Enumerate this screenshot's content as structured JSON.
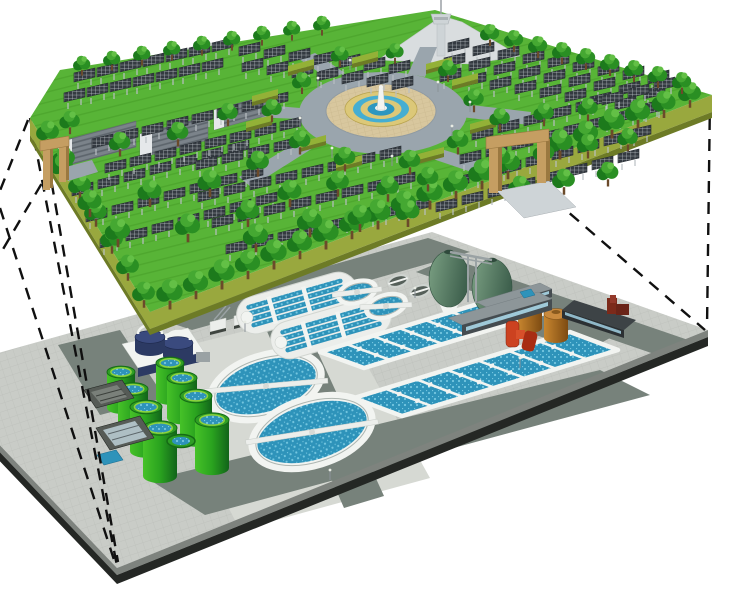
{
  "title": "Cutaway 3D illustration: underground wastewater treatment plant beneath a rooftop solar park with fountain plaza",
  "colors": {
    "grass": "#58b437",
    "grassLine": "#4ea72e",
    "edgeOlive": "#99a83e",
    "edgeOliveDark": "#6d7b26",
    "roadUpper": "#9aa5ad",
    "plaza": "#d8c79e",
    "plazaLine": "#c6b489",
    "cream": "#dcc878",
    "fountainBlue": "#45aed2",
    "fountainBlueDark": "#2d97c0",
    "white": "#f2f4f1",
    "towerGray": "#ced4d7",
    "bgBld": "#d9dddf",
    "shed": "#7b838a",
    "shedStripe": "#5c646b",
    "shedEnd": "#e5e8ea",
    "gateTan": "#c59e62",
    "gateTanDark": "#9a7840",
    "treeDark": "#1c7a1c",
    "treeMid": "#2a8f23",
    "treeLight": "#45a832",
    "treeHi": "#63c046",
    "trunk": "#6b4a2a",
    "panelDark": "#343a41",
    "panelLine": "#c9cfd3",
    "panelLeg": "#b9bfc3",
    "tile": "#c9ccc7",
    "tileLine": "#bcbfba",
    "lowerRoad": "#77827b",
    "pad": "#d6d9d3",
    "band1": "#7e837e",
    "band2": "#242724",
    "water": "#2e93ba",
    "waterDot": "#74c6e0",
    "tankGreenA": "#46c228",
    "tankGreenMid": "#2aa31f",
    "tankGreenB": "#11641a",
    "tankRim": "#2f9e25",
    "eggA": "#7ba083",
    "eggB": "#3f614e",
    "gantry": "#9aa2a4",
    "brownA": "#c8862f",
    "brownB": "#7d4b12",
    "brownTop": "#c98a3e",
    "navy": "#2c3a63",
    "navyTop": "#3a4a7e",
    "redA": "#cc4220",
    "redB": "#a82c12",
    "darkRed": "#7c2a1a",
    "bldTop": "#8d9699",
    "bldFront": "#454c50",
    "winBlue": "#9fc9d8",
    "bldDarkTop": "#3d4346",
    "skip": "#565b56",
    "skipIn": "#7a807a",
    "smallTank": "#555f59",
    "machineWhite": "#eceeeb",
    "dash": "#101010",
    "hedgeTop": "#93b137"
  },
  "scene": {
    "upper_level": {
      "name": "solar park on plant roof",
      "features": [
        "solar panel arrays",
        "tree rows",
        "central fountain plaza",
        "ring road",
        "observation tower",
        "warehouse sheds",
        "entrance gates",
        "hedges"
      ],
      "panel_fields": [
        {
          "o": [
            72,
            196
          ],
          "c": 7,
          "cs": [
            26,
            -7
          ],
          "r": 3,
          "rs": [
            14,
            26
          ]
        },
        {
          "o": [
            92,
            148
          ],
          "c": 8,
          "cs": [
            25,
            -6
          ],
          "r": 2,
          "rs": [
            13,
            25
          ]
        },
        {
          "o": [
            64,
            102
          ],
          "c": 7,
          "cs": [
            23,
            -5
          ],
          "r": 2,
          "rs": [
            10,
            -20
          ]
        },
        {
          "o": [
            242,
            72
          ],
          "c": 7,
          "cs": [
            25,
            3
          ],
          "r": 2,
          "rs": [
            -3,
            -16
          ]
        },
        {
          "o": [
            198,
            202
          ],
          "c": 8,
          "cs": [
            26,
            -6
          ],
          "r": 3,
          "rs": [
            14,
            26
          ]
        },
        {
          "o": [
            196,
            170
          ],
          "c": 4,
          "cs": [
            26,
            -6
          ],
          "r": 1,
          "rs": [
            0,
            0
          ]
        },
        {
          "o": [
            448,
            52
          ],
          "c": 9,
          "cs": [
            25,
            4
          ],
          "r": 3,
          "rs": [
            -4,
            15
          ]
        },
        {
          "o": [
            472,
            140
          ],
          "c": 8,
          "cs": [
            26,
            -7
          ],
          "r": 4,
          "rs": [
            -12,
            24
          ]
        }
      ],
      "trees": [
        [
          170,
          304,
          1.1
        ],
        [
          196,
          294,
          1.05
        ],
        [
          222,
          284,
          1.1
        ],
        [
          248,
          274,
          1.05
        ],
        [
          274,
          264,
          1.1
        ],
        [
          300,
          254,
          1.05
        ],
        [
          326,
          244,
          1.1
        ],
        [
          352,
          234,
          1.05
        ],
        [
          378,
          224,
          1.1
        ],
        [
          404,
          214,
          1.05
        ],
        [
          430,
          204,
          1.1
        ],
        [
          456,
          194,
          1.05
        ],
        [
          482,
          184,
          1.1
        ],
        [
          508,
          174,
          1.05
        ],
        [
          560,
          154,
          1.1
        ],
        [
          586,
          144,
          1.05
        ],
        [
          612,
          133,
          1.1
        ],
        [
          638,
          123,
          1.05
        ],
        [
          664,
          113,
          1.0
        ],
        [
          690,
          103,
          0.95
        ],
        [
          48,
          142,
          0.95
        ],
        [
          64,
          168,
          0.95
        ],
        [
          80,
          195,
          0.95
        ],
        [
          96,
          222,
          0.95
        ],
        [
          112,
          249,
          0.95
        ],
        [
          128,
          276,
          0.95
        ],
        [
          144,
          303,
          0.95
        ],
        [
          82,
          72,
          0.72
        ],
        [
          112,
          67,
          0.72
        ],
        [
          142,
          62,
          0.72
        ],
        [
          172,
          57,
          0.72
        ],
        [
          202,
          52,
          0.72
        ],
        [
          232,
          47,
          0.72
        ],
        [
          262,
          42,
          0.72
        ],
        [
          292,
          37,
          0.72
        ],
        [
          322,
          32,
          0.72
        ],
        [
          490,
          42,
          0.8
        ],
        [
          514,
          48,
          0.8
        ],
        [
          538,
          54,
          0.8
        ],
        [
          562,
          60,
          0.8
        ],
        [
          586,
          66,
          0.8
        ],
        [
          610,
          72,
          0.8
        ],
        [
          634,
          78,
          0.8
        ],
        [
          658,
          84,
          0.8
        ],
        [
          682,
          90,
          0.8
        ],
        [
          302,
          90,
          0.8
        ],
        [
          272,
          118,
          0.85
        ],
        [
          300,
          150,
          0.9
        ],
        [
          345,
          167,
          0.9
        ],
        [
          410,
          170,
          0.9
        ],
        [
          458,
          150,
          0.9
        ],
        [
          474,
          108,
          0.85
        ],
        [
          448,
          78,
          0.8
        ],
        [
          395,
          60,
          0.75
        ],
        [
          340,
          63,
          0.75
        ],
        [
          70,
          130,
          0.85
        ],
        [
          120,
          152,
          0.9
        ],
        [
          178,
          142,
          0.9
        ],
        [
          228,
          122,
          0.85
        ],
        [
          90,
          212,
          1.0
        ],
        [
          150,
          202,
          1.0
        ],
        [
          210,
          192,
          1.0
        ],
        [
          258,
          172,
          0.95
        ],
        [
          118,
          242,
          1.05
        ],
        [
          188,
          237,
          1.05
        ],
        [
          248,
          222,
          1.0
        ],
        [
          62,
          176,
          0.95
        ],
        [
          290,
          202,
          1.0
        ],
        [
          338,
          192,
          0.95
        ],
        [
          388,
          197,
          0.95
        ],
        [
          428,
          187,
          0.9
        ],
        [
          310,
          232,
          1.05
        ],
        [
          360,
          227,
          1.0
        ],
        [
          408,
          222,
          1.0
        ],
        [
          256,
          247,
          1.05
        ],
        [
          500,
          127,
          0.85
        ],
        [
          544,
          122,
          0.85
        ],
        [
          588,
          117,
          0.85
        ],
        [
          500,
          167,
          0.9
        ],
        [
          544,
          162,
          0.9
        ],
        [
          588,
          154,
          0.9
        ],
        [
          628,
          147,
          0.85
        ],
        [
          520,
          197,
          0.95
        ],
        [
          564,
          190,
          0.95
        ],
        [
          608,
          182,
          0.9
        ]
      ],
      "hedges": [
        [
          288,
          72
        ],
        [
          252,
          102
        ],
        [
          300,
          148
        ],
        [
          452,
          86
        ],
        [
          470,
          130
        ],
        [
          418,
          160
        ],
        [
          352,
          64
        ],
        [
          336,
          168
        ],
        [
          426,
          70
        ],
        [
          246,
          128
        ]
      ],
      "lamps": [
        [
          318,
          88
        ],
        [
          300,
          128
        ],
        [
          332,
          158
        ],
        [
          452,
          136
        ],
        [
          438,
          92
        ],
        [
          392,
          166
        ],
        [
          470,
          112
        ],
        [
          350,
          70
        ]
      ]
    },
    "lower_level": {
      "name": "underground wastewater treatment works",
      "features": [
        "circular clarifiers",
        "oxidation ditches",
        "aeration basins",
        "green sludge tanks",
        "egg-shaped digesters",
        "storage tanks",
        "service buildings",
        "pump equipment"
      ],
      "clarifiers": [
        {
          "cx": 266,
          "cy": 386,
          "r": 56,
          "rot": -17,
          "brot": 12
        },
        {
          "cx": 312,
          "cy": 432,
          "r": 61,
          "rot": -17,
          "brot": 8
        }
      ],
      "medium_tanks": [
        {
          "cx": 357,
          "cy": 292,
          "r": 19,
          "rot": -17,
          "brot": 10
        },
        {
          "cx": 386,
          "cy": 306,
          "r": 20,
          "rot": -17,
          "brot": 14
        }
      ],
      "small_tanks": [
        [
          398,
          281
        ],
        [
          420,
          291
        ]
      ],
      "ditches": [
        {
          "cx": 297,
          "cy": 303,
          "rot": -16
        },
        {
          "cx": 331,
          "cy": 328,
          "rot": -16
        }
      ],
      "basins": [
        {
          "A": [
            320,
            352
          ],
          "B": [
            504,
            296
          ],
          "w": [
            44,
            16
          ],
          "lanes": 7
        },
        {
          "A": [
            354,
            398
          ],
          "B": [
            570,
            332
          ],
          "w": [
            48,
            18
          ],
          "lanes": 7
        }
      ],
      "green_tanks": [
        [
          121,
          372,
          14,
          36
        ],
        [
          133,
          389,
          15,
          40
        ],
        [
          146,
          407,
          16,
          44
        ],
        [
          160,
          428,
          17,
          48
        ],
        [
          170,
          363,
          14,
          36
        ],
        [
          182,
          378,
          15,
          40
        ],
        [
          196,
          396,
          16,
          44
        ],
        [
          212,
          420,
          17,
          48
        ]
      ],
      "low_tank": [
        181,
        441,
        14,
        6.5
      ],
      "lamps": [
        [
          245,
          332
        ],
        [
          415,
          298
        ],
        [
          520,
          368
        ],
        [
          330,
          480
        ]
      ]
    },
    "projection_lines": [
      [
        28,
        120,
        -14,
        226
      ],
      [
        52,
        166,
        -14,
        278
      ],
      [
        48,
        162,
        118,
        562
      ],
      [
        30,
        118,
        117,
        566
      ],
      [
        0,
        208,
        116,
        566
      ],
      [
        710,
        97,
        707,
        328
      ],
      [
        538,
        186,
        705,
        330
      ]
    ]
  }
}
